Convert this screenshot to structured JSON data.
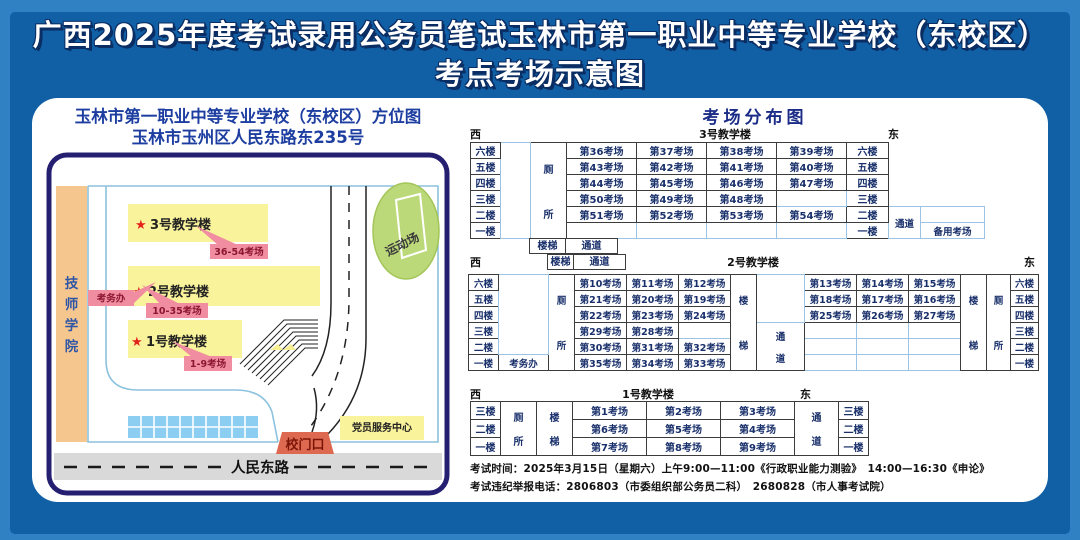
{
  "header": {
    "line1": "广西2025年度考试录用公务员笔试玉林市第一职业中等专业学校（东校区）",
    "line2": "考点考场示意图"
  },
  "map": {
    "title1": "玉林市第一职业中等专业学校（东校区）方位图",
    "title2": "玉林市玉州区人民东路东235号",
    "tech_chars": [
      "技",
      "师",
      "学",
      "院"
    ],
    "star": "★",
    "b3_label": "3号教学楼",
    "b3_tag": "36-54考场",
    "b2_label": "2号教学楼",
    "b2_tag": "10-35考场",
    "b1_label": "1号教学楼",
    "b1_tag": "1-9考场",
    "office_tag": "考务办",
    "playground": "运动场",
    "gate": "校门口",
    "party_center": "党员服务中心",
    "road": "人民东路"
  },
  "dist": {
    "title": "考场分布图",
    "west": "西",
    "east": "东",
    "legend": {
      "toilet": [
        "厕",
        "所"
      ],
      "stairs": [
        "楼",
        "梯"
      ],
      "corridor": [
        "通",
        "道"
      ],
      "stairs_h": "楼梯",
      "corridor_h": "通道",
      "office": "考务办",
      "backup": "备用考场"
    },
    "b3": {
      "name": "3号教学楼",
      "floors": [
        "六楼",
        "五楼",
        "四楼",
        "三楼",
        "二楼",
        "一楼"
      ],
      "rooms": [
        [
          "第36考场",
          "第37考场",
          "第38考场",
          "第39考场"
        ],
        [
          "第43考场",
          "第42考场",
          "第41考场",
          "第40考场"
        ],
        [
          "第44考场",
          "第45考场",
          "第46考场",
          "第47考场"
        ],
        [
          "第50考场",
          "第49考场",
          "第48考场",
          ""
        ],
        [
          "第51考场",
          "第52考场",
          "第53考场",
          "第54考场"
        ],
        [
          "",
          "",
          "",
          ""
        ]
      ]
    },
    "b2": {
      "name": "2号教学楼",
      "floors": [
        "六楼",
        "五楼",
        "四楼",
        "三楼",
        "二楼",
        "一楼"
      ],
      "west_rooms": [
        [
          "第10考场",
          "第11考场",
          "第12考场"
        ],
        [
          "第21考场",
          "第20考场",
          "第19考场"
        ],
        [
          "第22考场",
          "第23考场",
          "第24考场"
        ],
        [
          "第29考场",
          "第28考场",
          ""
        ],
        [
          "第30考场",
          "第31考场",
          "第32考场"
        ],
        [
          "第35考场",
          "第34考场",
          "第33考场"
        ]
      ],
      "east_rooms": [
        [
          "第13考场",
          "第14考场",
          "第15考场"
        ],
        [
          "第18考场",
          "第17考场",
          "第16考场"
        ],
        [
          "第25考场",
          "第26考场",
          "第27考场"
        ],
        [
          "",
          "",
          ""
        ],
        [
          "",
          "",
          ""
        ],
        [
          "",
          "",
          ""
        ]
      ]
    },
    "b1": {
      "name": "1号教学楼",
      "floors": [
        "三楼",
        "二楼",
        "一楼"
      ],
      "rooms": [
        [
          "第1考场",
          "第2考场",
          "第3考场"
        ],
        [
          "第6考场",
          "第5考场",
          "第4考场"
        ],
        [
          "第7考场",
          "第8考场",
          "第9考场"
        ]
      ]
    },
    "footer1": "考试时间：2025年3月15日（星期六）上午9:00—11:00《行政职业能力测验》　14:00—16:30《申论》",
    "footer2": "考试违纪举报电话：2806803（市委组织部公务员二科）　2680828（市人事考试院）"
  }
}
